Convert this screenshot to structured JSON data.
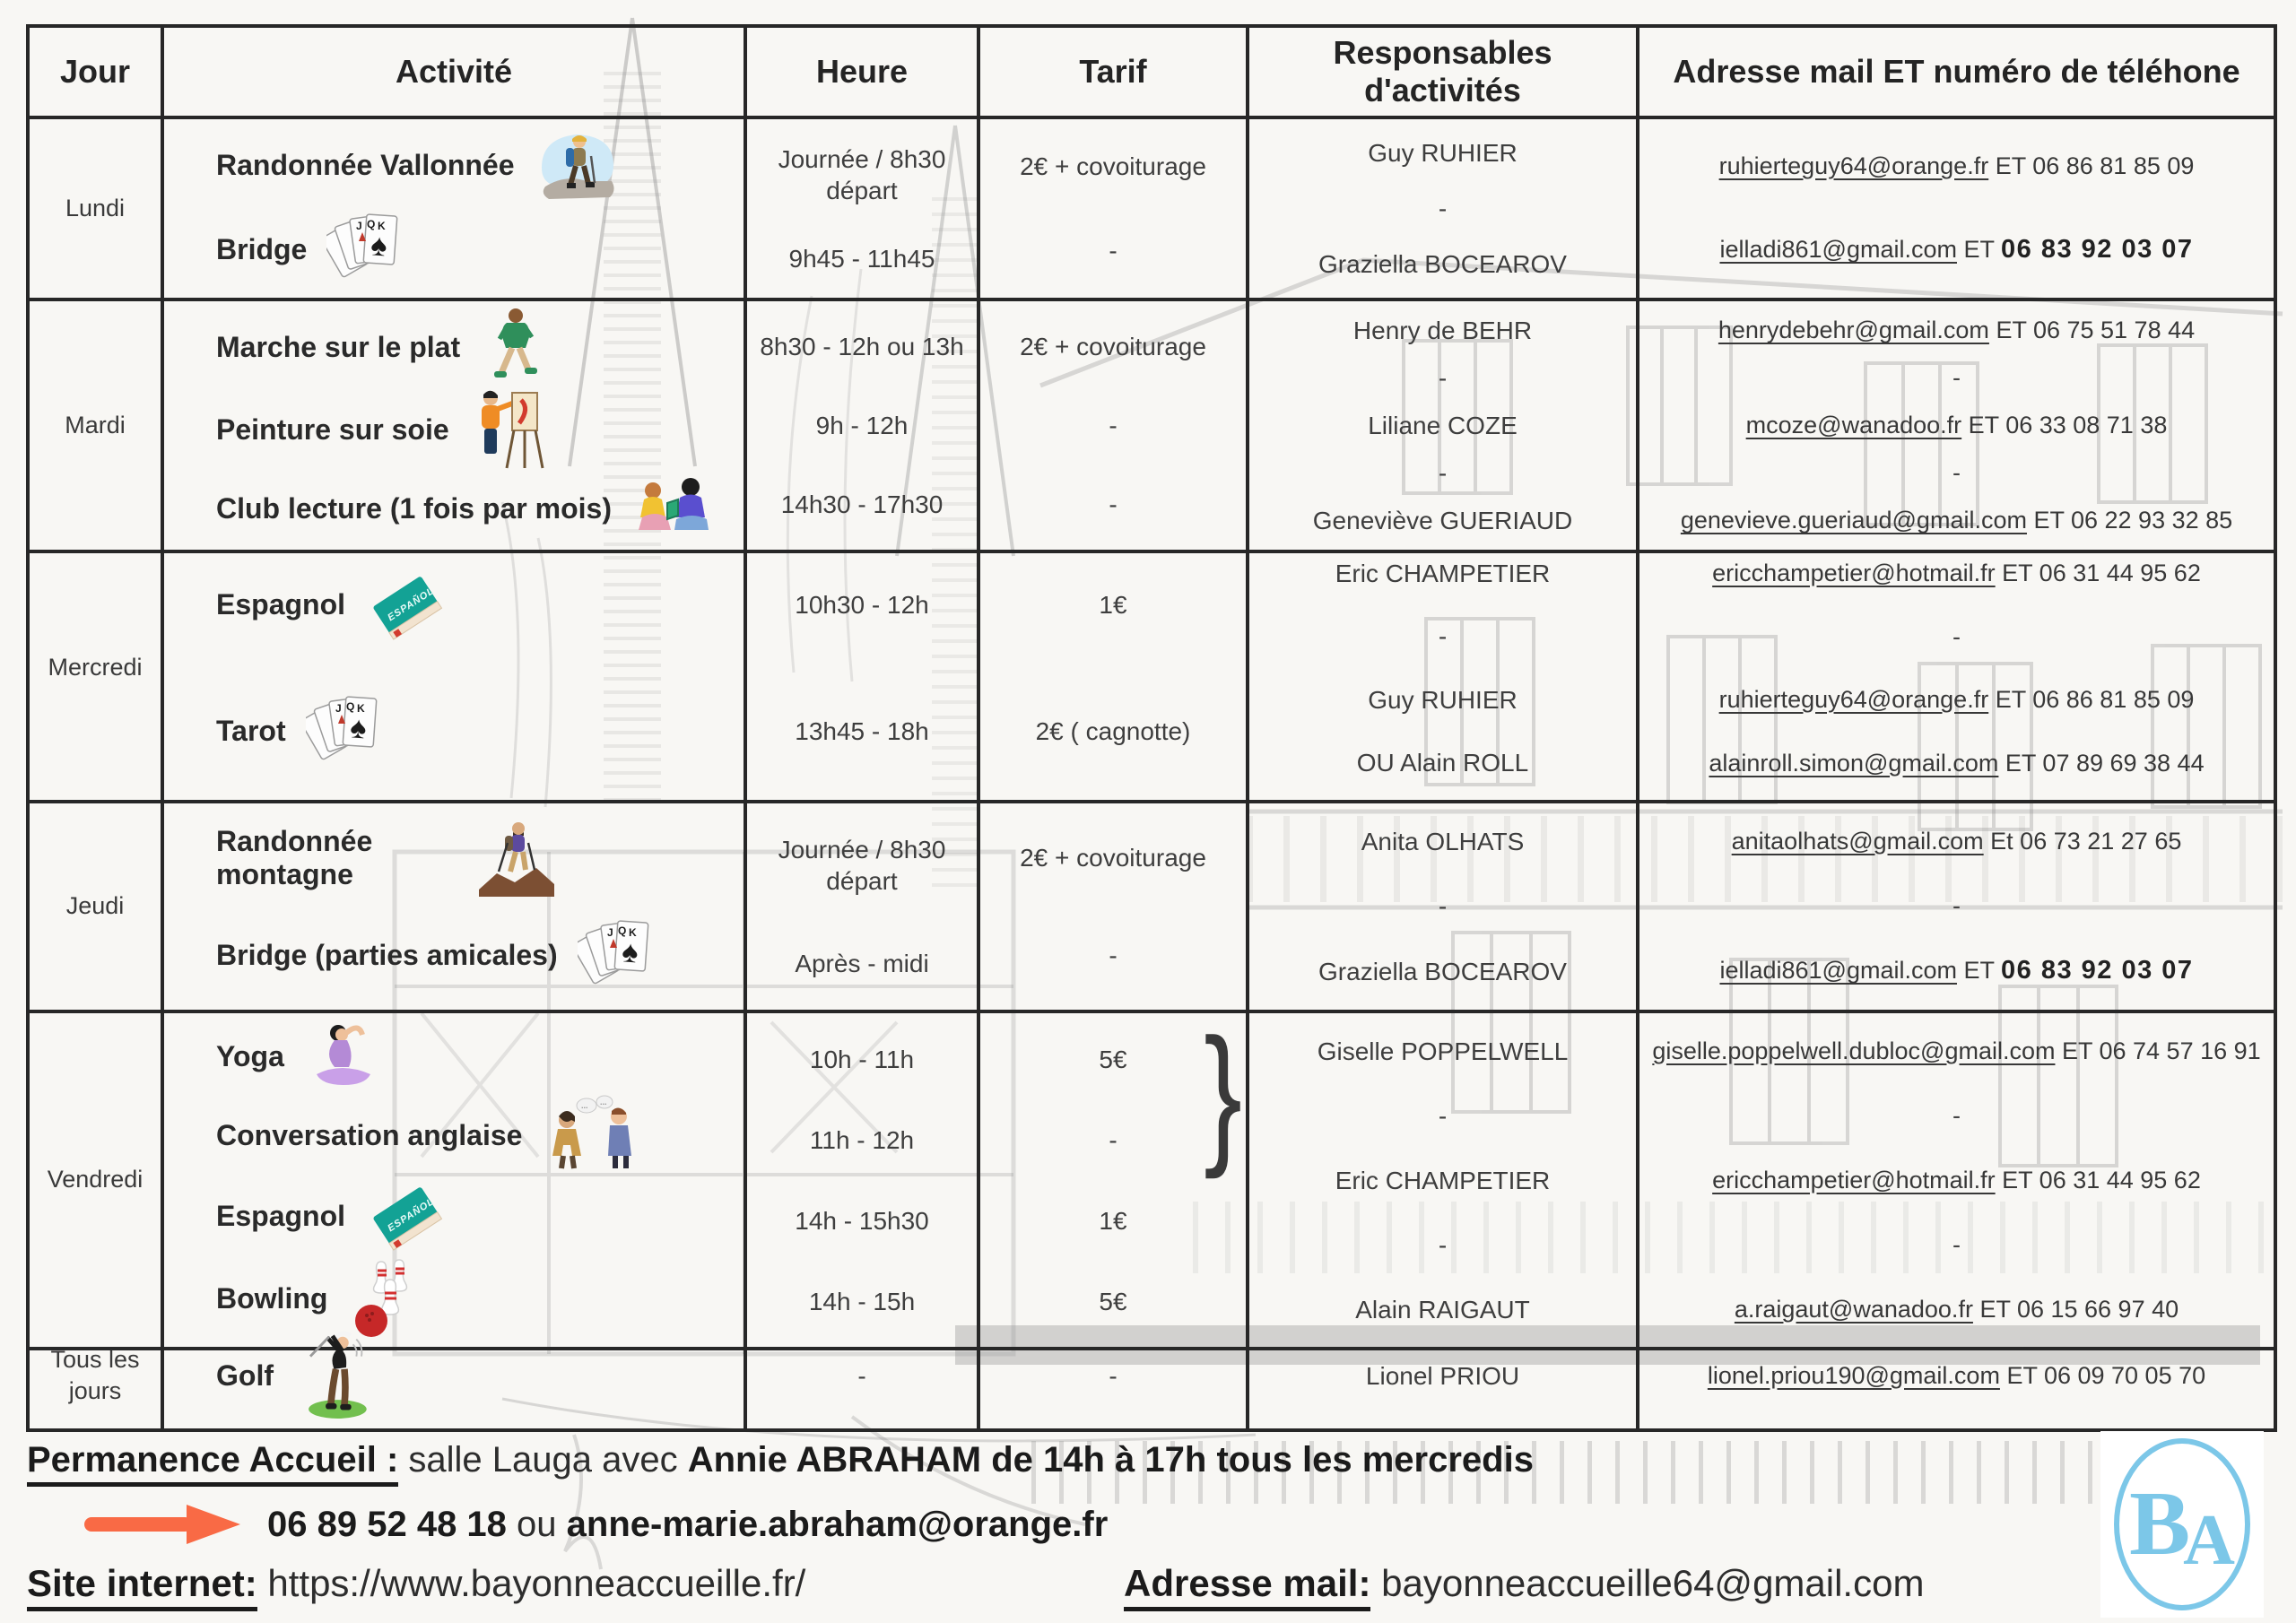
{
  "columns": [
    "Jour",
    "Activité",
    "Heure",
    "Tarif",
    "Responsables d'activités",
    "Adresse mail ET numéro de téléhone"
  ],
  "rows": [
    {
      "day": "Lundi",
      "activities": [
        {
          "label": "Randonnée Vallonnée",
          "icon": "hiker-icon"
        },
        {
          "label": "Bridge",
          "icon": "playing-cards-icon"
        }
      ],
      "heures": [
        "Journée / 8h30 départ",
        "9h45 - 11h45"
      ],
      "tarifs": [
        "2€  + covoiturage",
        "-"
      ],
      "responsables": [
        "Guy RUHIER",
        "-",
        "Graziella BOCEAROV"
      ],
      "contacts": [
        {
          "email": "ruhierteguy64@orange.fr",
          "rest": " ET 06 86 81 85 09"
        },
        {
          "email": "ielladi861@gmail.com",
          "rest": " ET ",
          "strong": "06 83 92 03 07"
        }
      ]
    },
    {
      "day": "Mardi",
      "activities": [
        {
          "label": "Marche sur le plat",
          "icon": "walker-icon"
        },
        {
          "label": "Peinture sur soie",
          "icon": "painter-icon"
        },
        {
          "label": "Club lecture (1 fois par mois)",
          "icon": "readers-icon"
        }
      ],
      "heures": [
        "8h30 - 12h ou 13h",
        "9h - 12h",
        "14h30 - 17h30"
      ],
      "tarifs": [
        "2€ + covoiturage",
        "-",
        "-"
      ],
      "responsables": [
        "Henry de BEHR",
        "-",
        "Liliane COZE",
        "-",
        "Geneviève GUERIAUD"
      ],
      "contacts": [
        {
          "email": "henrydebehr@gmail.com",
          "rest": " ET 06 75 51 78 44"
        },
        {
          "text": "-"
        },
        {
          "email": "mcoze@wanadoo.fr",
          "rest": " ET 06 33 08 71 38"
        },
        {
          "text": "-"
        },
        {
          "email": "genevieve.gueriaud@gmail.com",
          "rest": " ET 06 22 93 32 85"
        }
      ]
    },
    {
      "day": "Mercredi",
      "activities": [
        {
          "label": "Espagnol",
          "icon": "spanish-book-icon"
        },
        {
          "label": "Tarot",
          "icon": "playing-cards-icon"
        }
      ],
      "heures": [
        "10h30 - 12h",
        "13h45 - 18h"
      ],
      "tarifs": [
        "1€",
        "2€  ( cagnotte)"
      ],
      "responsables": [
        "Eric CHAMPETIER",
        "-",
        "Guy RUHIER",
        "OU Alain ROLL"
      ],
      "contacts": [
        {
          "email": "ericchampetier@hotmail.fr",
          "rest": " ET 06 31 44 95 62"
        },
        {
          "text": "-"
        },
        {
          "email": "ruhierteguy64@orange.fr",
          "rest": " ET 06 86 81 85 09"
        },
        {
          "email": "alainroll.simon@gmail.com",
          "rest": " ET 07 89 69 38 44"
        }
      ]
    },
    {
      "day": "Jeudi",
      "activities": [
        {
          "label": "Randonnée montagne",
          "icon": "mountain-hiker-icon"
        },
        {
          "label": "Bridge (parties amicales)",
          "icon": "playing-cards-icon"
        }
      ],
      "heures": [
        "Journée / 8h30 départ",
        "Après - midi"
      ],
      "tarifs": [
        "2€  + covoiturage",
        "-"
      ],
      "responsables": [
        "Anita OLHATS",
        "-",
        "Graziella BOCEAROV"
      ],
      "contacts": [
        {
          "email": "anitaolhats@gmail.com",
          "rest": " Et 06 73 21 27 65"
        },
        {
          "text": "-"
        },
        {
          "email": "ielladi861@gmail.com",
          "rest": " ET ",
          "strong": "06 83 92 03 07"
        }
      ]
    },
    {
      "day": "Vendredi",
      "activities": [
        {
          "label": "Yoga",
          "icon": "yoga-icon"
        },
        {
          "label": "Conversation anglaise",
          "icon": "conversation-icon"
        },
        {
          "label": "Espagnol",
          "icon": "spanish-book-icon"
        },
        {
          "label": "Bowling",
          "icon": "bowling-icon"
        }
      ],
      "heures": [
        "10h - 11h",
        "11h - 12h",
        "14h - 15h30",
        "14h - 15h"
      ],
      "tarifs": [
        "5€",
        "-",
        "1€",
        "5€"
      ],
      "brace": "}",
      "responsables": [
        "Giselle POPPELWELL",
        "-",
        "Eric CHAMPETIER",
        "-",
        "Alain RAIGAUT"
      ],
      "contacts": [
        {
          "email": "giselle.poppelwell.dubloc@gmail.com",
          "rest": " ET 06 74 57 16 91"
        },
        {
          "text": "-"
        },
        {
          "email": "ericchampetier@hotmail.fr",
          "rest": " ET 06 31 44 95 62"
        },
        {
          "text": "-"
        },
        {
          "email": "a.raigaut@wanadoo.fr",
          "rest": " ET 06 15 66 97 40"
        }
      ]
    },
    {
      "day": "Tous les jours",
      "activities": [
        {
          "label": "Golf",
          "icon": "golfer-icon"
        }
      ],
      "heures": [
        "-"
      ],
      "tarifs": [
        "-"
      ],
      "responsables": [
        "Lionel PRIOU"
      ],
      "contacts": [
        {
          "email": "lionel.priou190@gmail.com",
          "rest": " ET 06 09 70 05 70"
        }
      ]
    }
  ],
  "footer": {
    "permanence_label": "Permanence Accueil :",
    "permanence_mid": " salle Lauga avec ",
    "permanence_bold": "Annie ABRAHAM de 14h à 17h tous les mercredis",
    "arrow_icon": "right-arrow-icon",
    "phone": "06 89 52 48 18",
    "phone_mid": " ou ",
    "phone_email": "anne-marie.abraham@orange.fr",
    "site_label": "Site internet:",
    "site_value": " https://www.bayonneaccueille.fr/",
    "mail_label": "Adresse mail:",
    "mail_value": " bayonneaccueille64@gmail.com"
  },
  "logo": {
    "letter_b": "B",
    "letter_a": "A",
    "color": "#7cc7e8"
  },
  "colors": {
    "accent_arrow": "#f96a45",
    "logo_blue": "#7cc7e8",
    "border": "#272727"
  }
}
